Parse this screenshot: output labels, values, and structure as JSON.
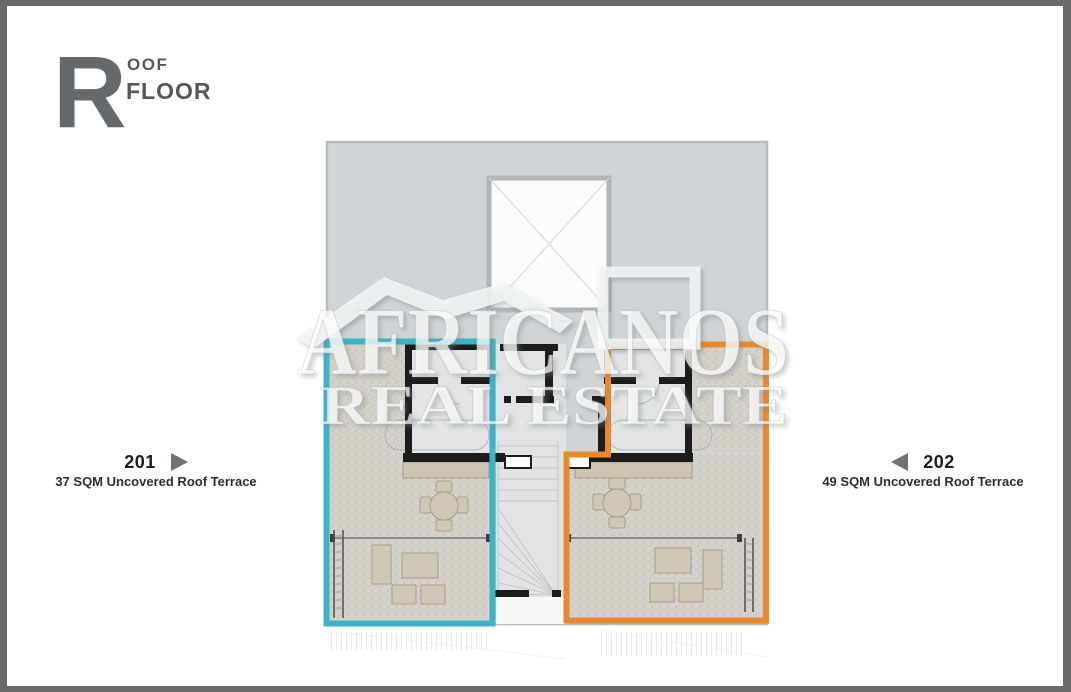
{
  "header": {
    "initial": "R",
    "title_top": "OOF",
    "title_bottom": "FLOOR"
  },
  "watermark": {
    "line1": "AFRICANOS",
    "line2": "REAL ESTATE"
  },
  "units": [
    {
      "id": "201",
      "area": "37 SQM Uncovered Roof Terrace",
      "outline_color": "#3db3c5",
      "arrow": "right"
    },
    {
      "id": "202",
      "area": "49 SQM Uncovered Roof Terrace",
      "outline_color": "#e9892e",
      "arrow": "left"
    }
  ],
  "colors": {
    "frame": "#696969",
    "backdrop": "#d0d4d6",
    "backdrop_border": "#b7bbbd",
    "terrace_floor": "#d5d2cb",
    "interior": "#e2e4e5",
    "wall": "#1c1c1c",
    "planter": "#cdc5b2",
    "furniture": "#d0c8b7",
    "furniture_border": "#a79f8d",
    "unit201_outline": "#3db3c5",
    "unit202_outline": "#e9892e",
    "heading_gray": "#65696c",
    "text_dark": "#54585b",
    "arrow_gray": "#6d7276",
    "label_dark": "#1d1d1d"
  }
}
